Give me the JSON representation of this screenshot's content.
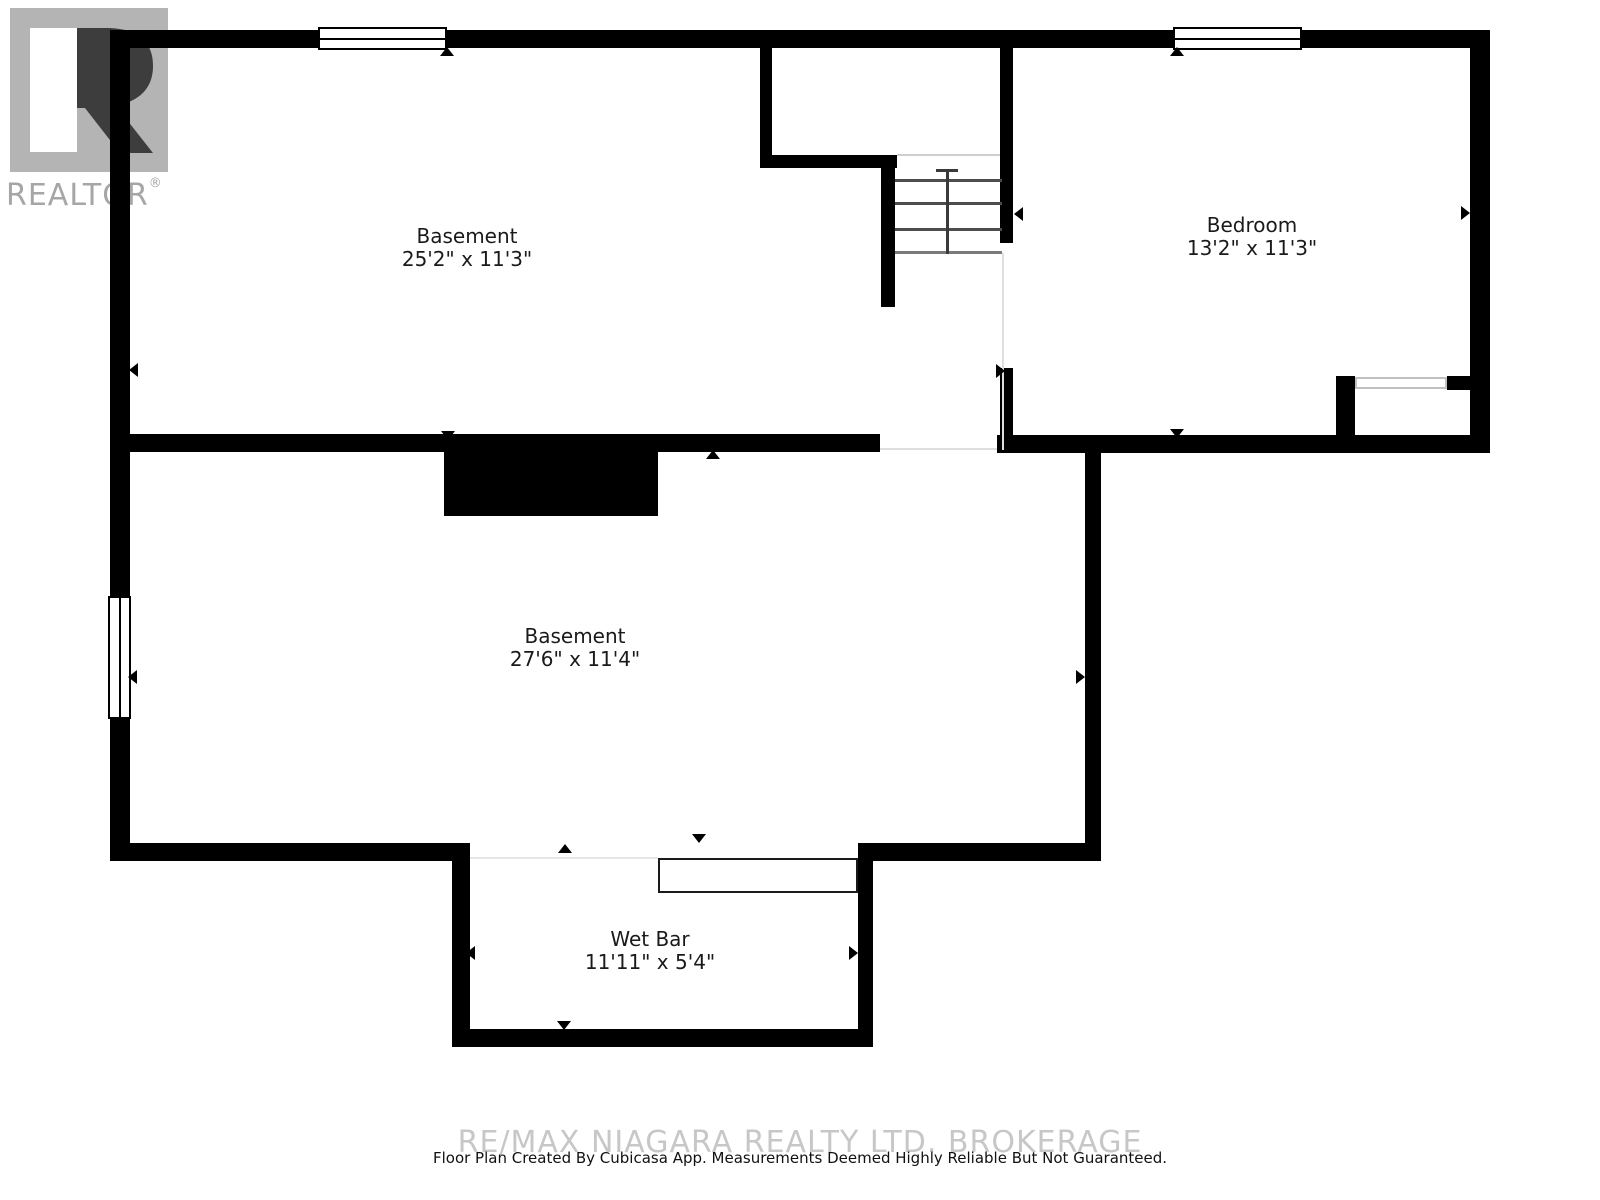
{
  "branding": {
    "logo_letter": "R",
    "logo_word": "REALTOR",
    "registered_mark": "®",
    "logo_square_color": "#b4b4b4",
    "logo_word_color": "#a6a6a6"
  },
  "rooms": [
    {
      "id": "basement-upper",
      "name": "Basement",
      "dimensions": "25'2\" x 11'3\""
    },
    {
      "id": "bedroom",
      "name": "Bedroom",
      "dimensions": "13'2\" x 11'3\""
    },
    {
      "id": "basement-lower",
      "name": "Basement",
      "dimensions": "27'6\" x 11'4\""
    },
    {
      "id": "wet-bar",
      "name": "Wet Bar",
      "dimensions": "11'11\" x 5'4\""
    }
  ],
  "footer": {
    "watermark": "RE/MAX NIAGARA REALTY LTD. BROKERAGE",
    "disclaimer": "Floor Plan Created By Cubicasa App. Measurements Deemed Highly Reliable But Not Guaranteed."
  },
  "colors": {
    "wall": "#000000",
    "stair_line": "#4d4d4d",
    "boundary_line": "#dedede",
    "label_text": "#1a1a1a",
    "watermark_text": "#c7c7c7"
  }
}
